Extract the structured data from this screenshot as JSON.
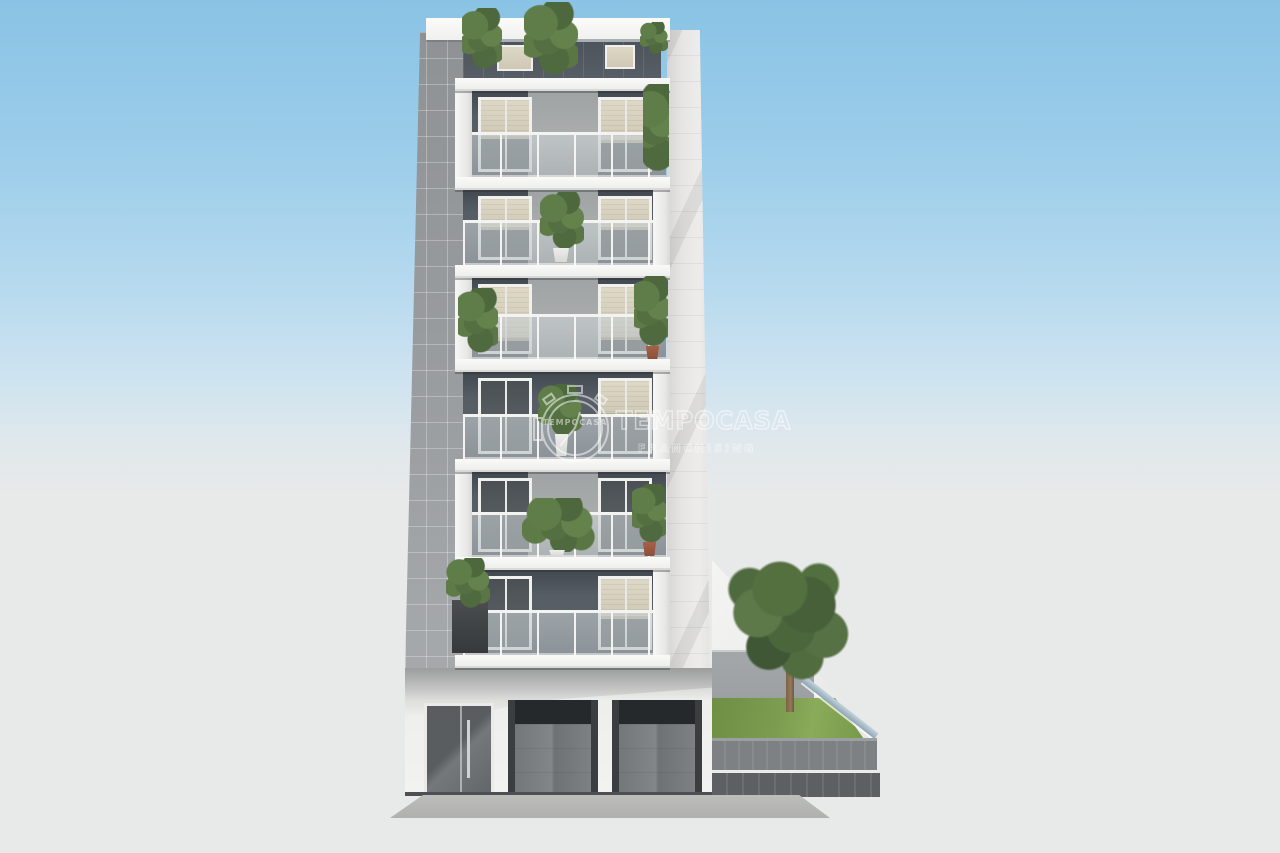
{
  "scene": {
    "type": "3D architectural rendering",
    "subject": "Modern multi-storey residential building, front elevation with stacked balconies",
    "balcony_floors": 7,
    "ground_floor_openings": [
      "entrance glass door",
      "garage door",
      "garage door"
    ],
    "garden": "side garden on the right with lawn, tree and gray fence",
    "sky": "clear blue gradient sky"
  },
  "watermark": {
    "brand_text": "TEMPOCASA",
    "subtitle_text": "FRANCHISING",
    "logo_clock_text": "TEMPOCASA"
  },
  "colors": {
    "sky_top": "#8ac3e5",
    "sky_horizon": "#e0e8ec",
    "ground": "#e8e9e9",
    "facade_white": "#f4f4f2",
    "facade_dark_wall": "#565d64",
    "pier_tiles_gray": "#9a9da0",
    "glass_balustrade": "#9aa1a5",
    "shutter_beige": "#d8d2bf",
    "lawn_green": "#7d9d50",
    "tree_green": "#55703f",
    "fence_gray": "#797d80",
    "terracotta_pot": "#a86046",
    "watermark_white": "#ffffff"
  }
}
